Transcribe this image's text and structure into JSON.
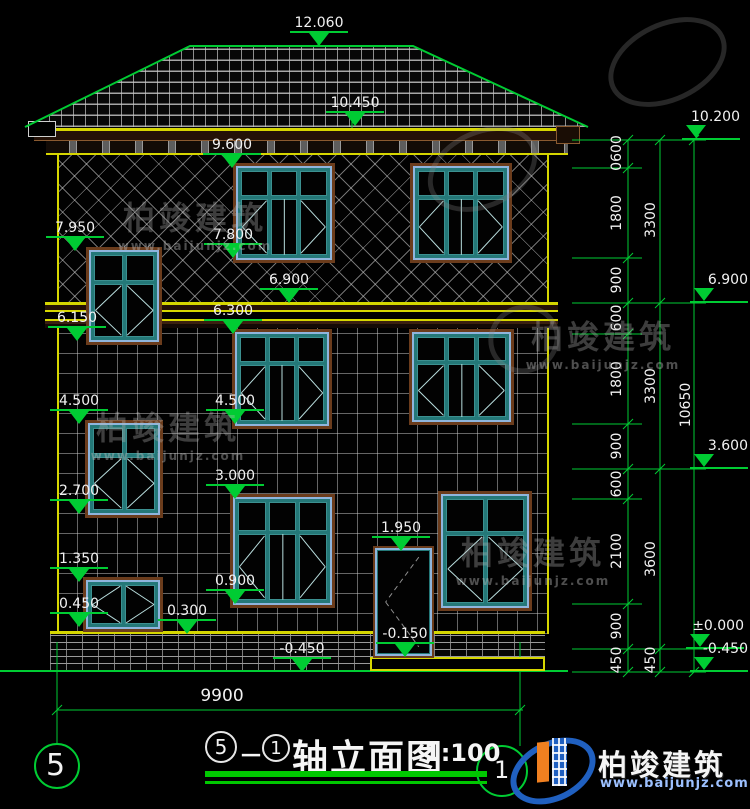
{
  "drawing": {
    "title": {
      "axis_start": "5",
      "separator": "－",
      "axis_end": "1",
      "name": "轴立面图",
      "scale": "1:100"
    },
    "axis_bubbles": {
      "left": "5",
      "right": "1"
    },
    "elevation_markers": [
      {
        "label": "12.060"
      },
      {
        "label": "10.450"
      },
      {
        "label": "9.600"
      },
      {
        "label": "7.950"
      },
      {
        "label": "7.800"
      },
      {
        "label": "6.900"
      },
      {
        "label": "6.300"
      },
      {
        "label": "6.150"
      },
      {
        "label": "4.500"
      },
      {
        "label": "4.500"
      },
      {
        "label": "3.000"
      },
      {
        "label": "2.700"
      },
      {
        "label": "1.950"
      },
      {
        "label": "1.350"
      },
      {
        "label": "0.900"
      },
      {
        "label": "0.450"
      },
      {
        "label": "0.300"
      },
      {
        "label": "-0.150"
      },
      {
        "label": "-0.450"
      },
      {
        "label": "10.200"
      },
      {
        "label": "6.900"
      },
      {
        "label": "3.600"
      },
      {
        "label": "±0.000"
      },
      {
        "label": "-0.450"
      }
    ],
    "dim_chains": {
      "inner": [
        "0600",
        "1800",
        "900",
        "600",
        "1800",
        "900",
        "600",
        "2100",
        "900",
        "450"
      ],
      "middle": [
        "3300",
        "3300",
        "3600",
        "450"
      ],
      "outer": "10650",
      "overall_width": "9900"
    },
    "brand": {
      "name": "柏竣建筑",
      "url": "www.baijunjz.com"
    },
    "watermark": {
      "name": "柏竣建筑",
      "url": "www.baijunjz.com"
    },
    "colors": {
      "dim_green": "#00cc33",
      "outline_yellow": "#d6d600",
      "frame_teal": "#247878",
      "frame_blue": "#8fb5dd",
      "trim_brown": "#6b3c1c",
      "logo_blue": "#2060c0",
      "logo_orange": "#f08020"
    }
  }
}
